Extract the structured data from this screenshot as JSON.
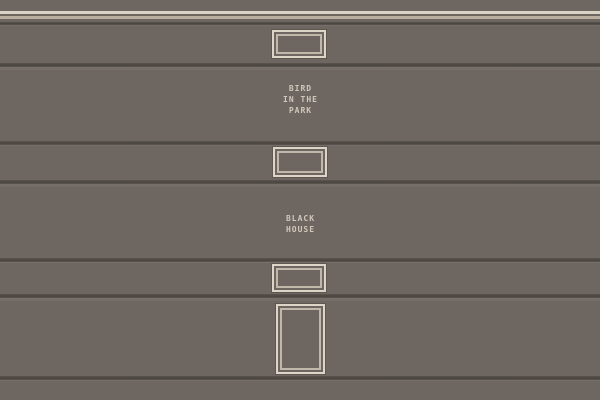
{
  "illustration": {
    "description": "Stacked horizontal panels with trim stripes, window frames, a door frame and two panel titles",
    "titles": [
      {
        "id": "bird-in-the-park",
        "lines": [
          "BIRD",
          "IN THE",
          "PARK"
        ]
      },
      {
        "id": "black-house",
        "lines": [
          "BLACK",
          "HOUSE"
        ]
      }
    ]
  },
  "colors": {
    "wall": "#6d6661",
    "groove": "#4a443e",
    "trim_bright": "#dad4c6",
    "trim_muted": "#b9b09f",
    "frame_outer": "#dcd6c9",
    "frame_inner": "#c0b8ab",
    "lettering": "#d0c9bb"
  }
}
